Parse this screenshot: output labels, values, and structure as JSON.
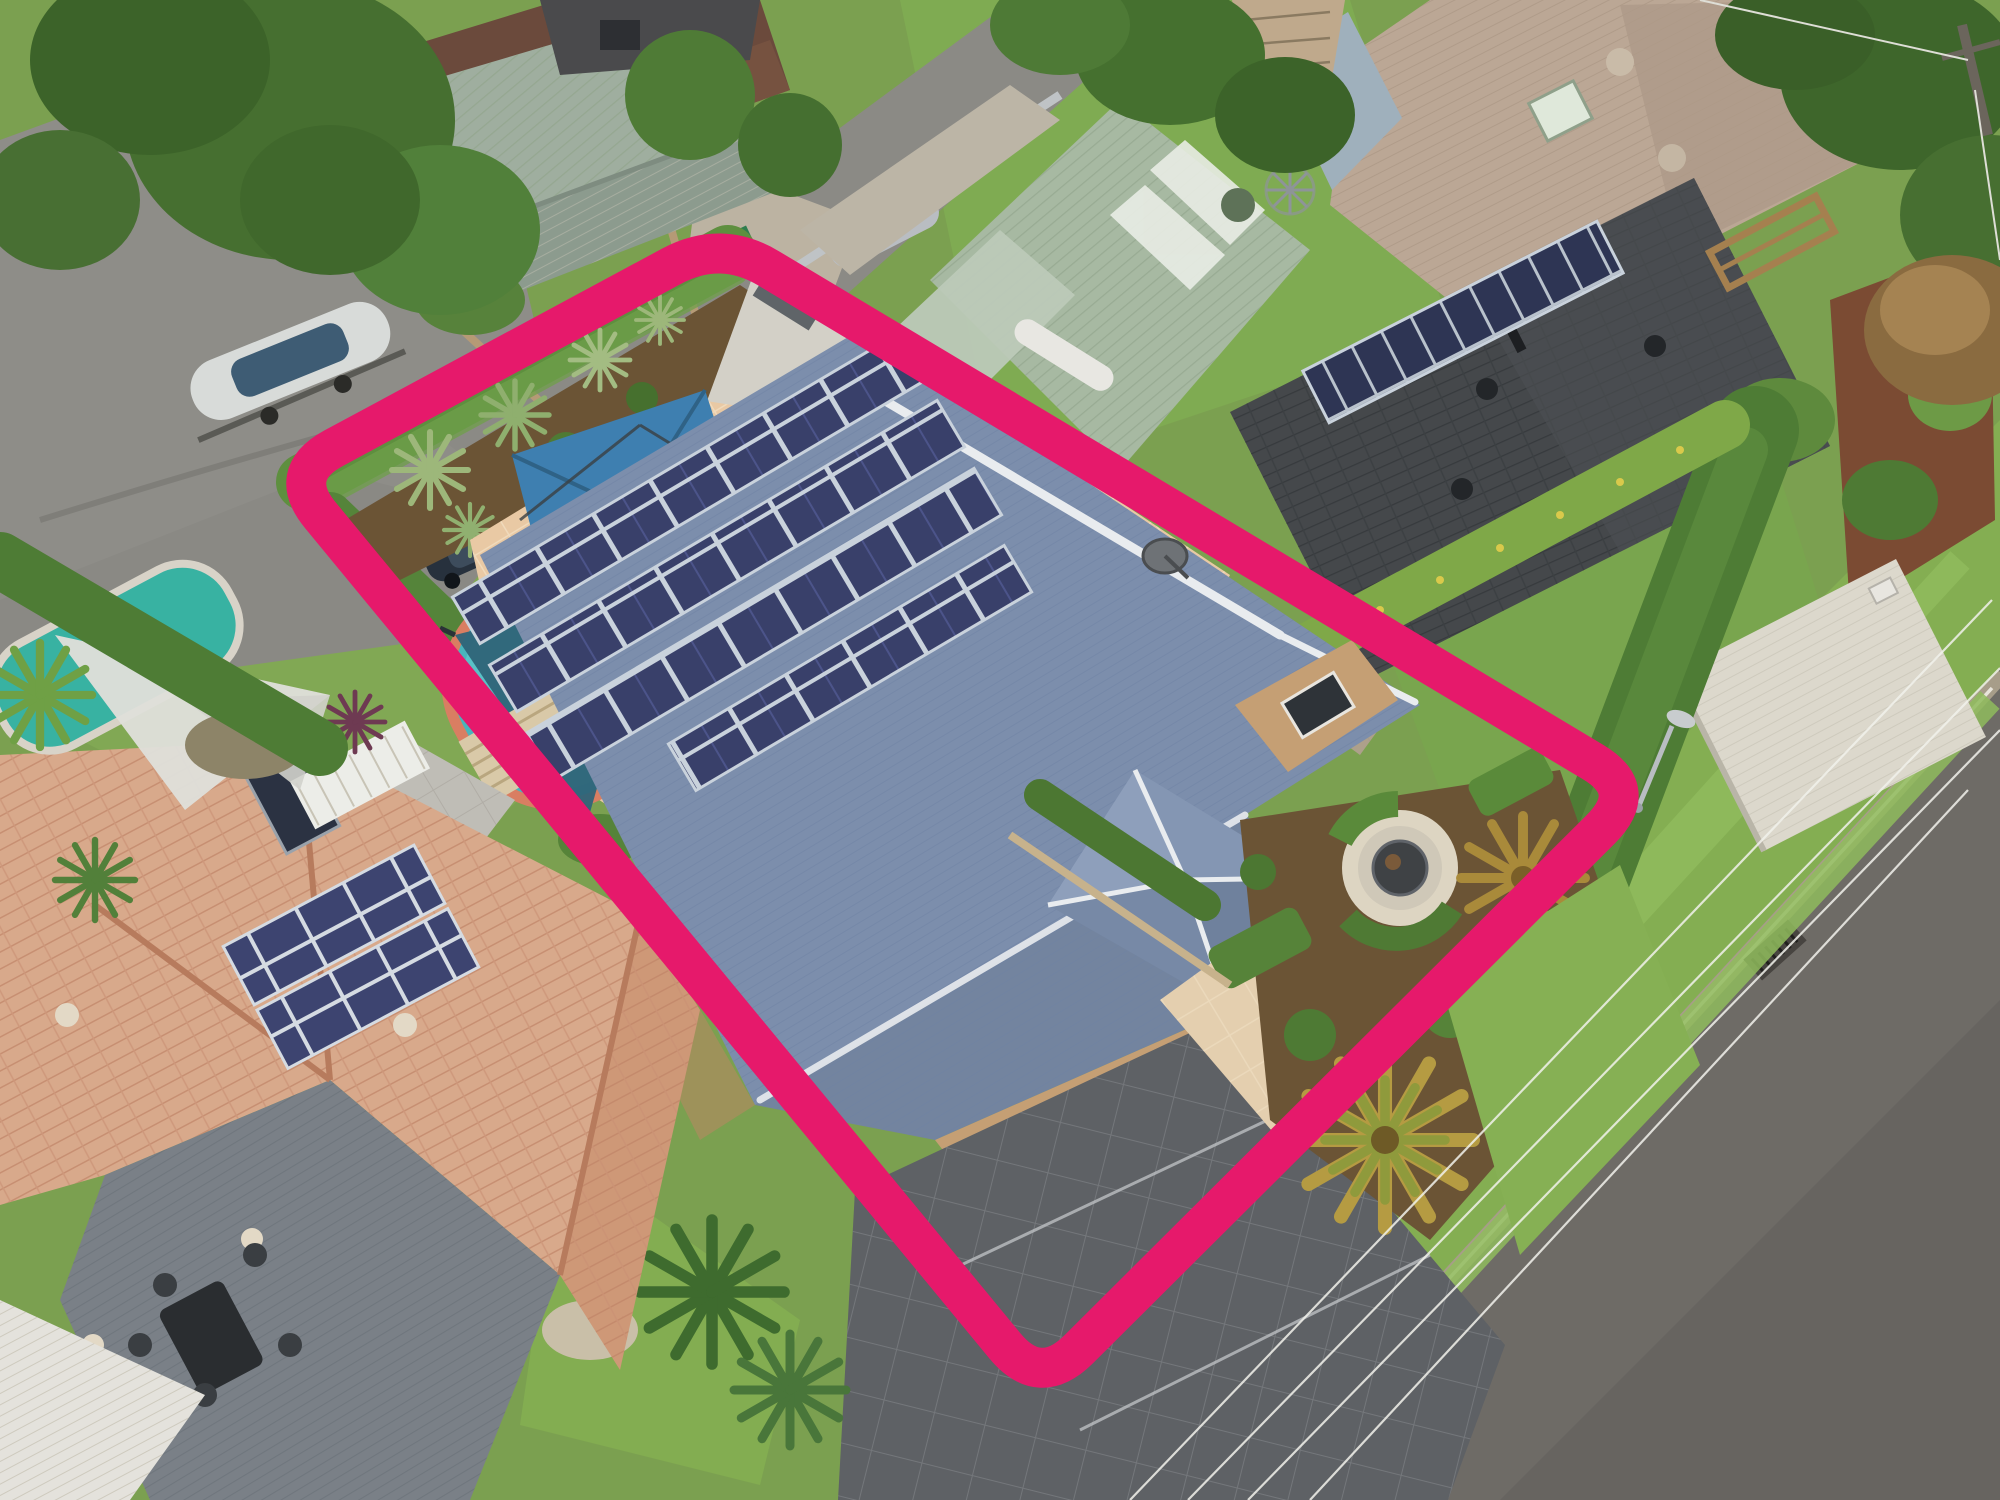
{
  "image": {
    "kind": "aerial-drone-real-estate-photo",
    "subject": "Suburban property highlighted with a pink boundary outline",
    "width_px": 2000,
    "height_px": 1500,
    "visible_text": []
  },
  "boundary_outline": {
    "color": "#E6196B",
    "stroke_width_px": 40,
    "corner_radius_px": 55,
    "corners_px": [
      [
        721,
        240
      ],
      [
        1640,
        790
      ],
      [
        1040,
        1388
      ],
      [
        286,
        474
      ]
    ]
  },
  "main_property": {
    "house": {
      "roof_type": "hipped corrugated metal",
      "roof_color": "#7C8EAC",
      "ridge_capping_color": "#E9ECEF",
      "solar_panel_rows": [
        8,
        8,
        8,
        6
      ],
      "solar_panel_color": "#39406A",
      "satellite_dish": true,
      "front_porch_pyramid_roof": true,
      "wall_color_brick": "#C59F74",
      "garage_door_color": "#DCD9D2"
    },
    "pool_area": {
      "pool_shape": "kidney",
      "water_color": "#49B4BC",
      "coping_color": "#D97E62",
      "paving_color": "#E9C9A4",
      "shade_sails": {
        "count": 3,
        "color": "#37708B"
      },
      "cantilever_umbrella": {
        "shape": "square",
        "color": "#3E7FB0"
      },
      "terracotta_pots": 9,
      "sun_loungers": 2,
      "glass_pool_fence": true,
      "concrete_pad_color": "#D3D0C7"
    },
    "front_yard": {
      "driveway_color": "#5E6165",
      "driveway_pattern": "diamond grid pavers",
      "circular_pebble_garden": {
        "fire_pit_color": "#3F4245",
        "pebble_color": "#DDD5C2"
      },
      "cycads": 2,
      "clipped_box_hedges": true,
      "lawn_color": "#86B054"
    },
    "hedges_color": "#5E8F3F"
  },
  "neighbors": {
    "top_left": {
      "roof_color": "#6B4A3C",
      "bay_window": true,
      "large_tree": true,
      "parked_car_color": "#2A3440"
    },
    "top_center": {
      "shed_roof_color": "#9FAE9F",
      "boat_on_trailer": true,
      "parked_car_color": "#B9BDC2"
    },
    "top_right_tan_house": {
      "roof_color": "#BBA795",
      "skylight": true
    },
    "sage_carport": {
      "roof_color": "#A7B9A2",
      "skylight_strips": 3
    },
    "right_charcoal_house": {
      "roof_color": "#45484B",
      "solar_panels": 10,
      "roof_vents": 4
    },
    "white_carport_color": "#DCD8CC",
    "bottom_left": {
      "roof_color": "#D8A98B",
      "solar_panels": 8,
      "solar_hot_water_panel": true,
      "deck_color": "#7A8087",
      "outdoor_dining_set": true,
      "pool_color": "#38B2A2",
      "white_shade_sail": true,
      "white_patio_roof": true
    }
  },
  "street": {
    "asphalt_color": "#6E6B66",
    "curb_color": "#A79D89",
    "verge_grass_color": "#84AE52",
    "overhead_power_lines": 4,
    "street_light": true,
    "storm_drain_grate": true,
    "power_pole_top_right": true
  },
  "vegetation_palette": [
    "#466F30",
    "#3C6329",
    "#51803A",
    "#5E8F3F",
    "#7FA848",
    "#8A6B40",
    "#B59B42"
  ],
  "ground_palette": {
    "base_grass": "#7BA050",
    "upper_road": "#8E8D88",
    "mulch": "#6B5435",
    "red_mulch": "#7B4B33"
  }
}
